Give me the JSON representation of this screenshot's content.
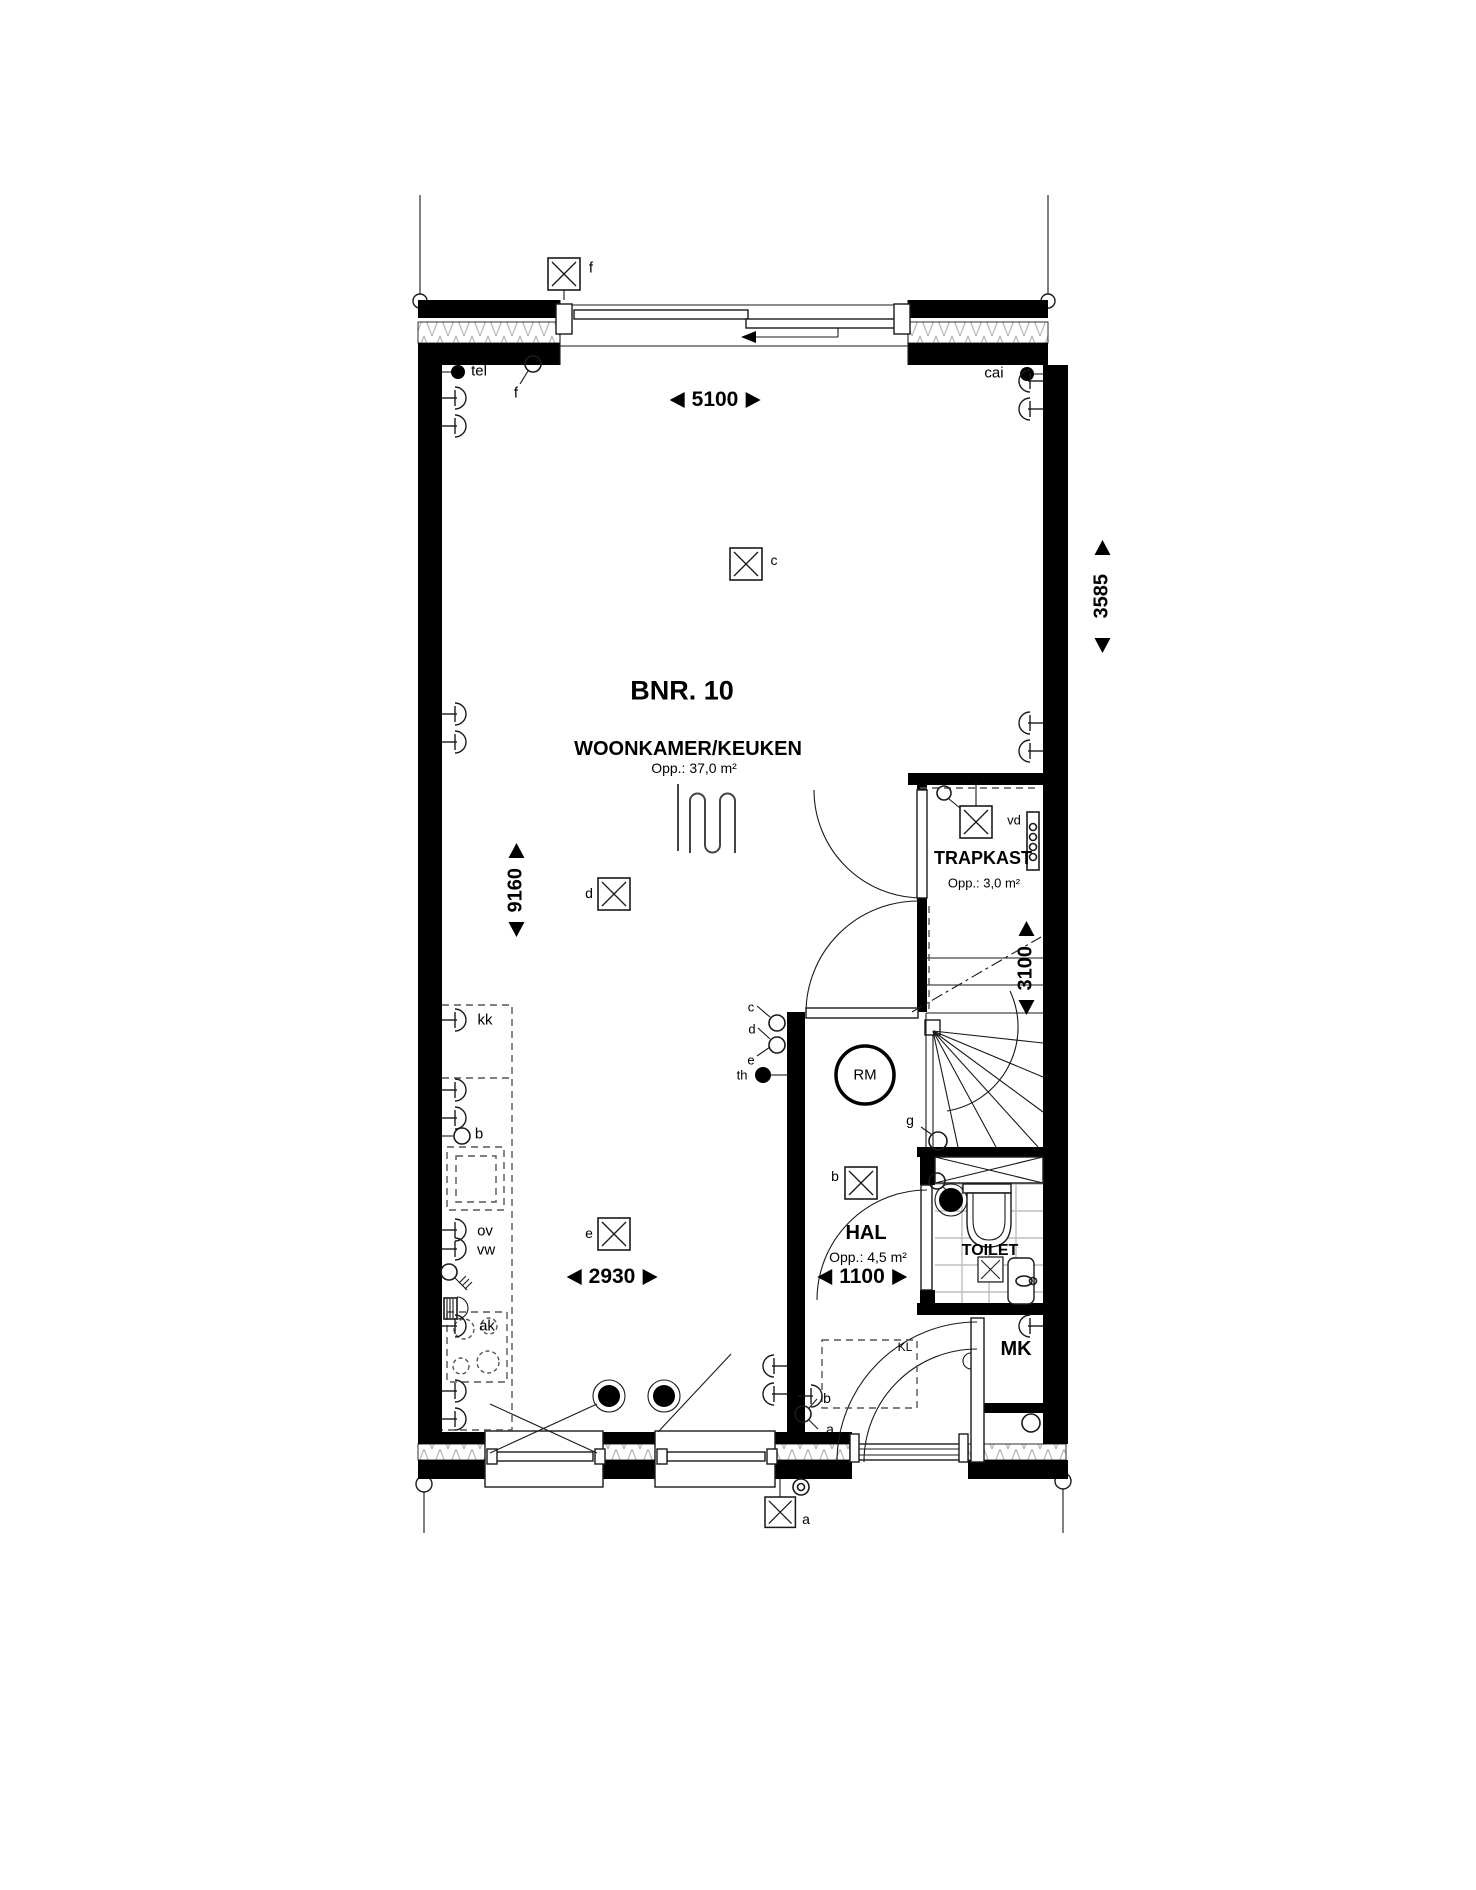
{
  "plan": {
    "unit": "BNR. 10",
    "rooms": {
      "living_kitchen": {
        "name": "WOONKAMER/KEUKEN",
        "area": "Opp.: 37,0 m²"
      },
      "trapkast": {
        "name": "TRAPKAST",
        "area": "Opp.: 3,0 m²"
      },
      "hal": {
        "name": "HAL",
        "area": "Opp.: 4,5 m²"
      },
      "toilet": {
        "name": "TOILET"
      },
      "meterkast": {
        "name": "MK"
      }
    },
    "dimensions": {
      "top_width": "5100",
      "right_upper_height": "3585",
      "left_height": "9160",
      "stair_depth": "3100",
      "kitchen_width": "2930",
      "hal_width": "1100"
    },
    "labels": {
      "ceiling_light_f": "f",
      "switch_f": "f",
      "tel_outlet": "tel",
      "cai_outlet": "cai",
      "ceiling_light_c": "c",
      "ceiling_light_d": "d",
      "ceiling_light_e": "e",
      "ceiling_light_b": "b",
      "switch_c": "c",
      "switch_d": "d",
      "switch_e": "e",
      "thermostat": "th",
      "smoke_detector": "RM",
      "switch_g": "g",
      "distributor_vd": "vd",
      "socket_kk": "kk",
      "boiler_b": "b",
      "socket_ov": "ov",
      "socket_vw": "vw",
      "cooktop_ak": "ak",
      "socket_b_hal": "b",
      "switch_a_hal": "a",
      "exterior_light_a": "a",
      "crawl_hatch_kl": "KL"
    },
    "colors": {
      "wall_fill": "#000000",
      "line": "#1a1a1a",
      "tile_line": "#bdbdbd",
      "hatch_line": "#b5b5b5",
      "dashed_line": "#555555",
      "background": "#ffffff"
    }
  }
}
